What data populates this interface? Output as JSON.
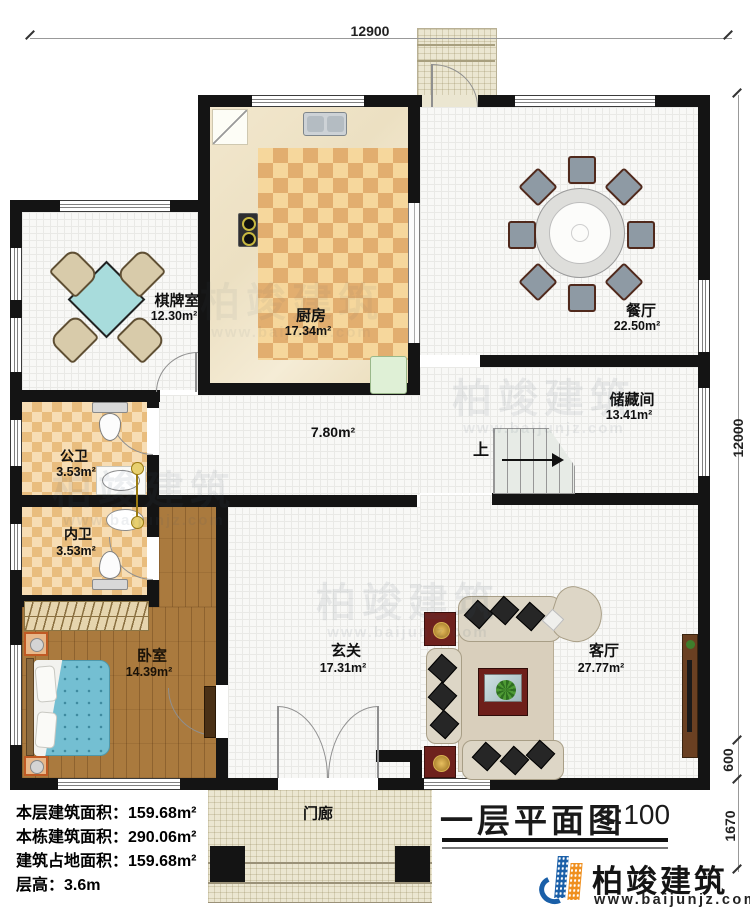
{
  "plan": {
    "title": "一层平面图",
    "scale": "1:100"
  },
  "brand": {
    "name": "柏竣建筑",
    "url": "www.baijunjz.com"
  },
  "watermark": {
    "name": "柏竣建筑",
    "url": "www.baijunjz.com"
  },
  "dimensions": {
    "top_width": "12900",
    "right_height": "12000",
    "right_mid": "600",
    "right_bottom": "1670"
  },
  "stats": {
    "floor_area": "本层建筑面积：159.68m²",
    "building_area": "本栋建筑面积：290.06m²",
    "footprint_area": "建筑占地面积：159.68m²",
    "floor_height": "层高：3.6m"
  },
  "rooms": {
    "chess_room": {
      "name": "棋牌室",
      "area": "12.30m²"
    },
    "kitchen": {
      "name": "厨房",
      "area": "17.34m²"
    },
    "dining_room": {
      "name": "餐厅",
      "area": "22.50m²"
    },
    "storage_room": {
      "name": "储藏间",
      "area": "13.41m²"
    },
    "hallway": {
      "area": "7.80m²"
    },
    "public_bathroom": {
      "name": "公卫",
      "area": "3.53m²"
    },
    "ensuite_bathroom": {
      "name": "内卫",
      "area": "3.53m²"
    },
    "bedroom": {
      "name": "卧室",
      "area": "14.39m²"
    },
    "foyer": {
      "name": "玄关",
      "area": "17.31m²"
    },
    "living_room": {
      "name": "客厅",
      "area": "27.77m²"
    },
    "porch": {
      "name": "门廊"
    },
    "stairs": {
      "direction_label": "上"
    }
  },
  "colors": {
    "wall": "#141414",
    "brand_blue": "#1a5fa8",
    "brand_orange": "#ef8f1e",
    "kitchen_tile": "#e2ae6f",
    "bath_tile": "#e9bd7e",
    "wood_floor": "#aa7a3e",
    "table_teal": "#a8dcdc",
    "bed_blue": "#74bfd2"
  }
}
